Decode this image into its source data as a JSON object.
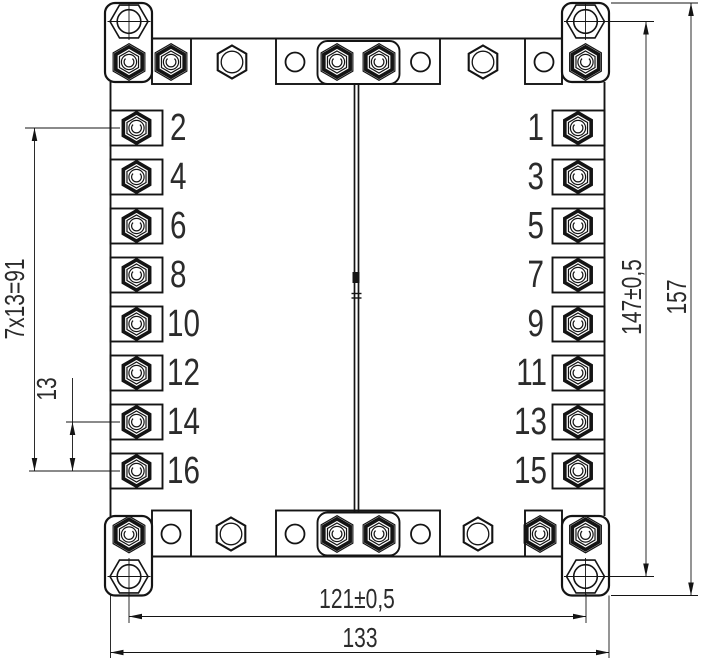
{
  "drawing": {
    "background_color": "#ffffff",
    "line_color": "#141414",
    "text_color": "#2b2b2b",
    "terminals": {
      "left": [
        "2",
        "4",
        "6",
        "8",
        "10",
        "12",
        "14",
        "16"
      ],
      "right": [
        "1",
        "3",
        "5",
        "7",
        "9",
        "11",
        "13",
        "15"
      ]
    },
    "dimensions": {
      "terminal_pitch_total": "7x13=91",
      "terminal_pitch": "13",
      "mounting_spacing_h": "121±0,5",
      "overall_width": "133",
      "mounting_spacing_v": "147±0,5",
      "overall_height": "157"
    }
  }
}
